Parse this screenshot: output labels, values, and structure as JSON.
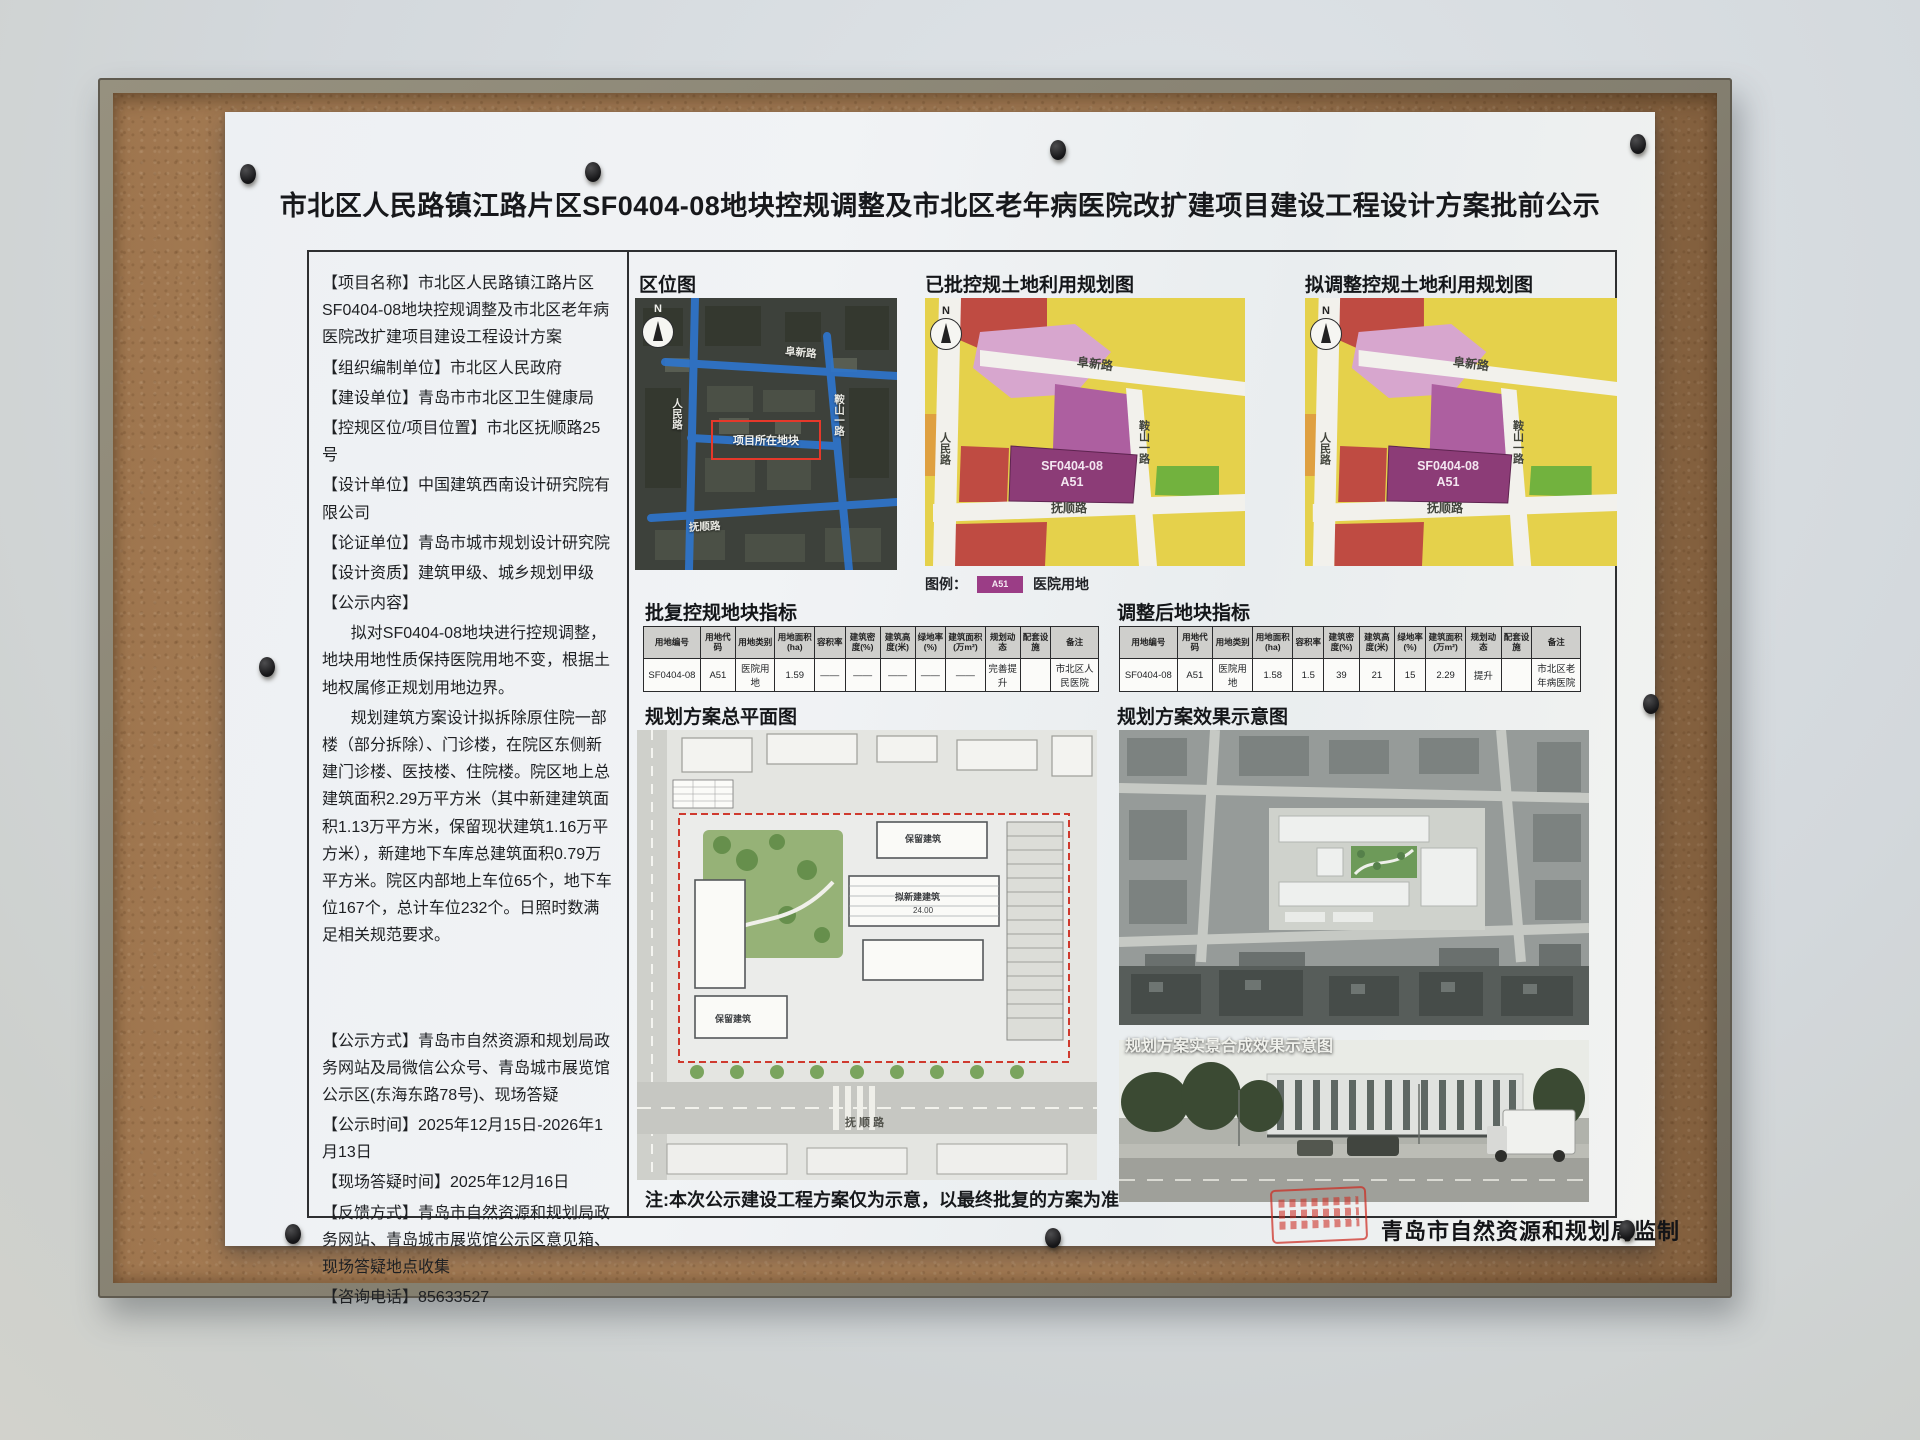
{
  "poster": {
    "title": "市北区人民路镇江路片区SF0404-08地块控规调整及市北区老年病医院改扩建项目建设工程设计方案批前公示",
    "note": "注:本次公示建设工程方案仅为示意，以最终批复的方案为准",
    "supervisor": "青岛市自然资源和规划局监制"
  },
  "info_panel": {
    "p1": "【项目名称】市北区人民路镇江路片区SF0404-08地块控规调整及市北区老年病医院改扩建项目建设工程设计方案",
    "p2": "【组织编制单位】市北区人民政府",
    "p3": "【建设单位】青岛市市北区卫生健康局",
    "p4": "【控规区位/项目位置】市北区抚顺路25号",
    "p5": "【设计单位】中国建筑西南设计研究院有限公司",
    "p6": "【论证单位】青岛市城市规划设计研究院",
    "p7": "【设计资质】建筑甲级、城乡规划甲级",
    "p8": "【公示内容】",
    "p9": "拟对SF0404-08地块进行控规调整，地块用地性质保持医院用地不变，根据土地权属修正规划用地边界。",
    "p10": "规划建筑方案设计拟拆除原住院一部楼（部分拆除）、门诊楼，在院区东侧新建门诊楼、医技楼、住院楼。院区地上总建筑面积2.29万平方米（其中新建建筑面积1.13万平方米，保留现状建筑1.16万平方米），新建地下车库总建筑面积0.79万平方米。院区内部地上车位65个，地下车位167个，总计车位232个。日照时数满足相关规范要求。",
    "p11": "【公示方式】青岛市自然资源和规划局政务网站及局微信公众号、青岛城市展览馆公示区(东海东路78号)、现场答疑",
    "p12": "【公示时间】2025年12月15日-2026年1月13日",
    "p13": "【现场答疑时间】2025年12月16日",
    "p14": "【反馈方式】青岛市自然资源和规划局政务网站、青岛城市展览馆公示区意见箱、现场答疑地点收集",
    "p15": "【咨询电话】85633527"
  },
  "location_map": {
    "title": "区位图",
    "north": "N",
    "marker": "项目所在地块",
    "roads": {
      "top": "阜新路",
      "left": "人民路",
      "right": "鞍山一路",
      "bottom": "抚顺路"
    }
  },
  "approved_map": {
    "title": "已批控规土地利用规划图"
  },
  "adjusted_map": {
    "title": "拟调整控规土地利用规划图"
  },
  "landuse": {
    "north": "N",
    "parcel_code": "SF0404-08",
    "parcel_type": "A51",
    "roads": {
      "top": "阜新路",
      "right": "鞍山一路",
      "left": "人民路",
      "bottom": "抚顺路"
    }
  },
  "legend": {
    "prefix": "图例：",
    "code": "A51",
    "label": "医院用地"
  },
  "approved_table": {
    "title": "批复控规地块指标",
    "headers": [
      "用地编号",
      "用地代码",
      "用地类别",
      "用地面积(ha)",
      "容积率",
      "建筑密度(%)",
      "建筑高度(米)",
      "绿地率(%)",
      "建筑面积(万m²)",
      "规划动态",
      "配套设施",
      "备注"
    ],
    "row": [
      "SF0404-08",
      "A51",
      "医院用地",
      "1.59",
      "——",
      "——",
      "——",
      "——",
      "——",
      "完善提升",
      "",
      "市北区人民医院"
    ]
  },
  "adjusted_table": {
    "title": "调整后地块指标",
    "headers": [
      "用地编号",
      "用地代码",
      "用地类别",
      "用地面积(ha)",
      "容积率",
      "建筑密度(%)",
      "建筑高度(米)",
      "绿地率(%)",
      "建筑面积(万m²)",
      "规划动态",
      "配套设施",
      "备注"
    ],
    "row": [
      "SF0404-08",
      "A51",
      "医院用地",
      "1.58",
      "1.5",
      "39",
      "21",
      "15",
      "2.29",
      "提升",
      "",
      "市北区老年病医院"
    ]
  },
  "site_plan": {
    "title": "规划方案总平面图",
    "label_retained": "保留建筑",
    "label_retained2": "保留建筑",
    "label_new": "拟新建建筑",
    "elev": "24.00",
    "road": "抚 顺 路"
  },
  "render_view": {
    "title": "规划方案效果示意图"
  },
  "composite_view": {
    "label": "规划方案实景合成效果示意图"
  }
}
